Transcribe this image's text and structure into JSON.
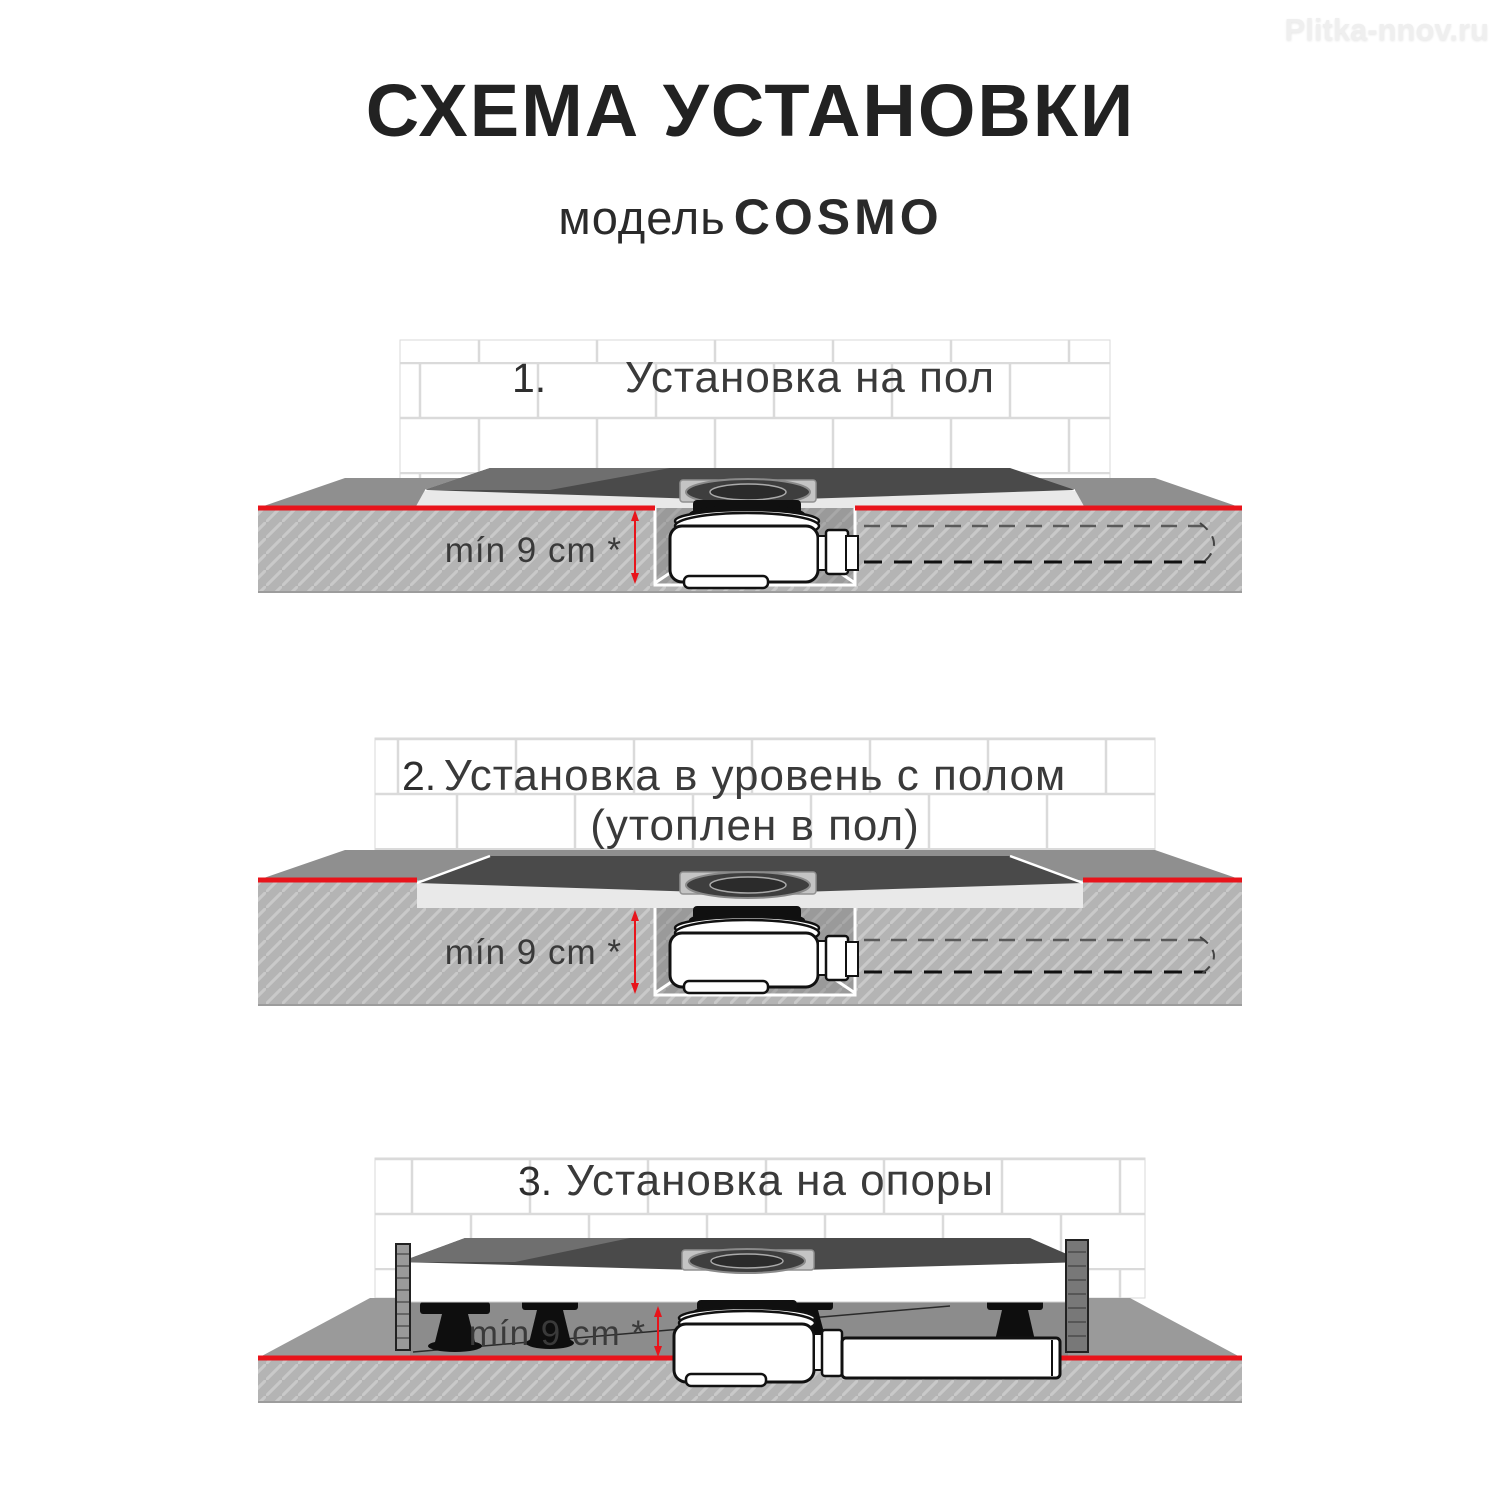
{
  "watermark": {
    "text": "Plitka-nnov.ru"
  },
  "header": {
    "title": "СХЕМА УСТАНОВКИ",
    "model_label": "модель",
    "model_name": "COSMO"
  },
  "figures": {
    "fig1": {
      "number": "1.",
      "title": "Установка на пол",
      "dimension": "mín 9 cm *"
    },
    "fig2": {
      "number": "2.",
      "title_line1": "Установка в уровень с полом",
      "title_line2": "(утоплен в пол)",
      "dimension": "mín 9 cm *"
    },
    "fig3": {
      "number": "3.",
      "title": "Установка на опоры",
      "dimension": "mín 9 cm *"
    }
  },
  "colors": {
    "accent_red": "#e8141b",
    "slab_gray": "#b4b4b4",
    "slab_hatch": "#c9c9c9",
    "floor_top_gray": "#8f8f8f",
    "pit_gray": "#9a9a9a",
    "tray_dark": "#4a4a4a",
    "tray_rim": "#e9e9e9",
    "tile_grout": "#dadada",
    "siphon_white": "#ffffff",
    "gasket_black": "#101010",
    "text_dark": "#222222",
    "watermark_gray": "#efefef"
  }
}
